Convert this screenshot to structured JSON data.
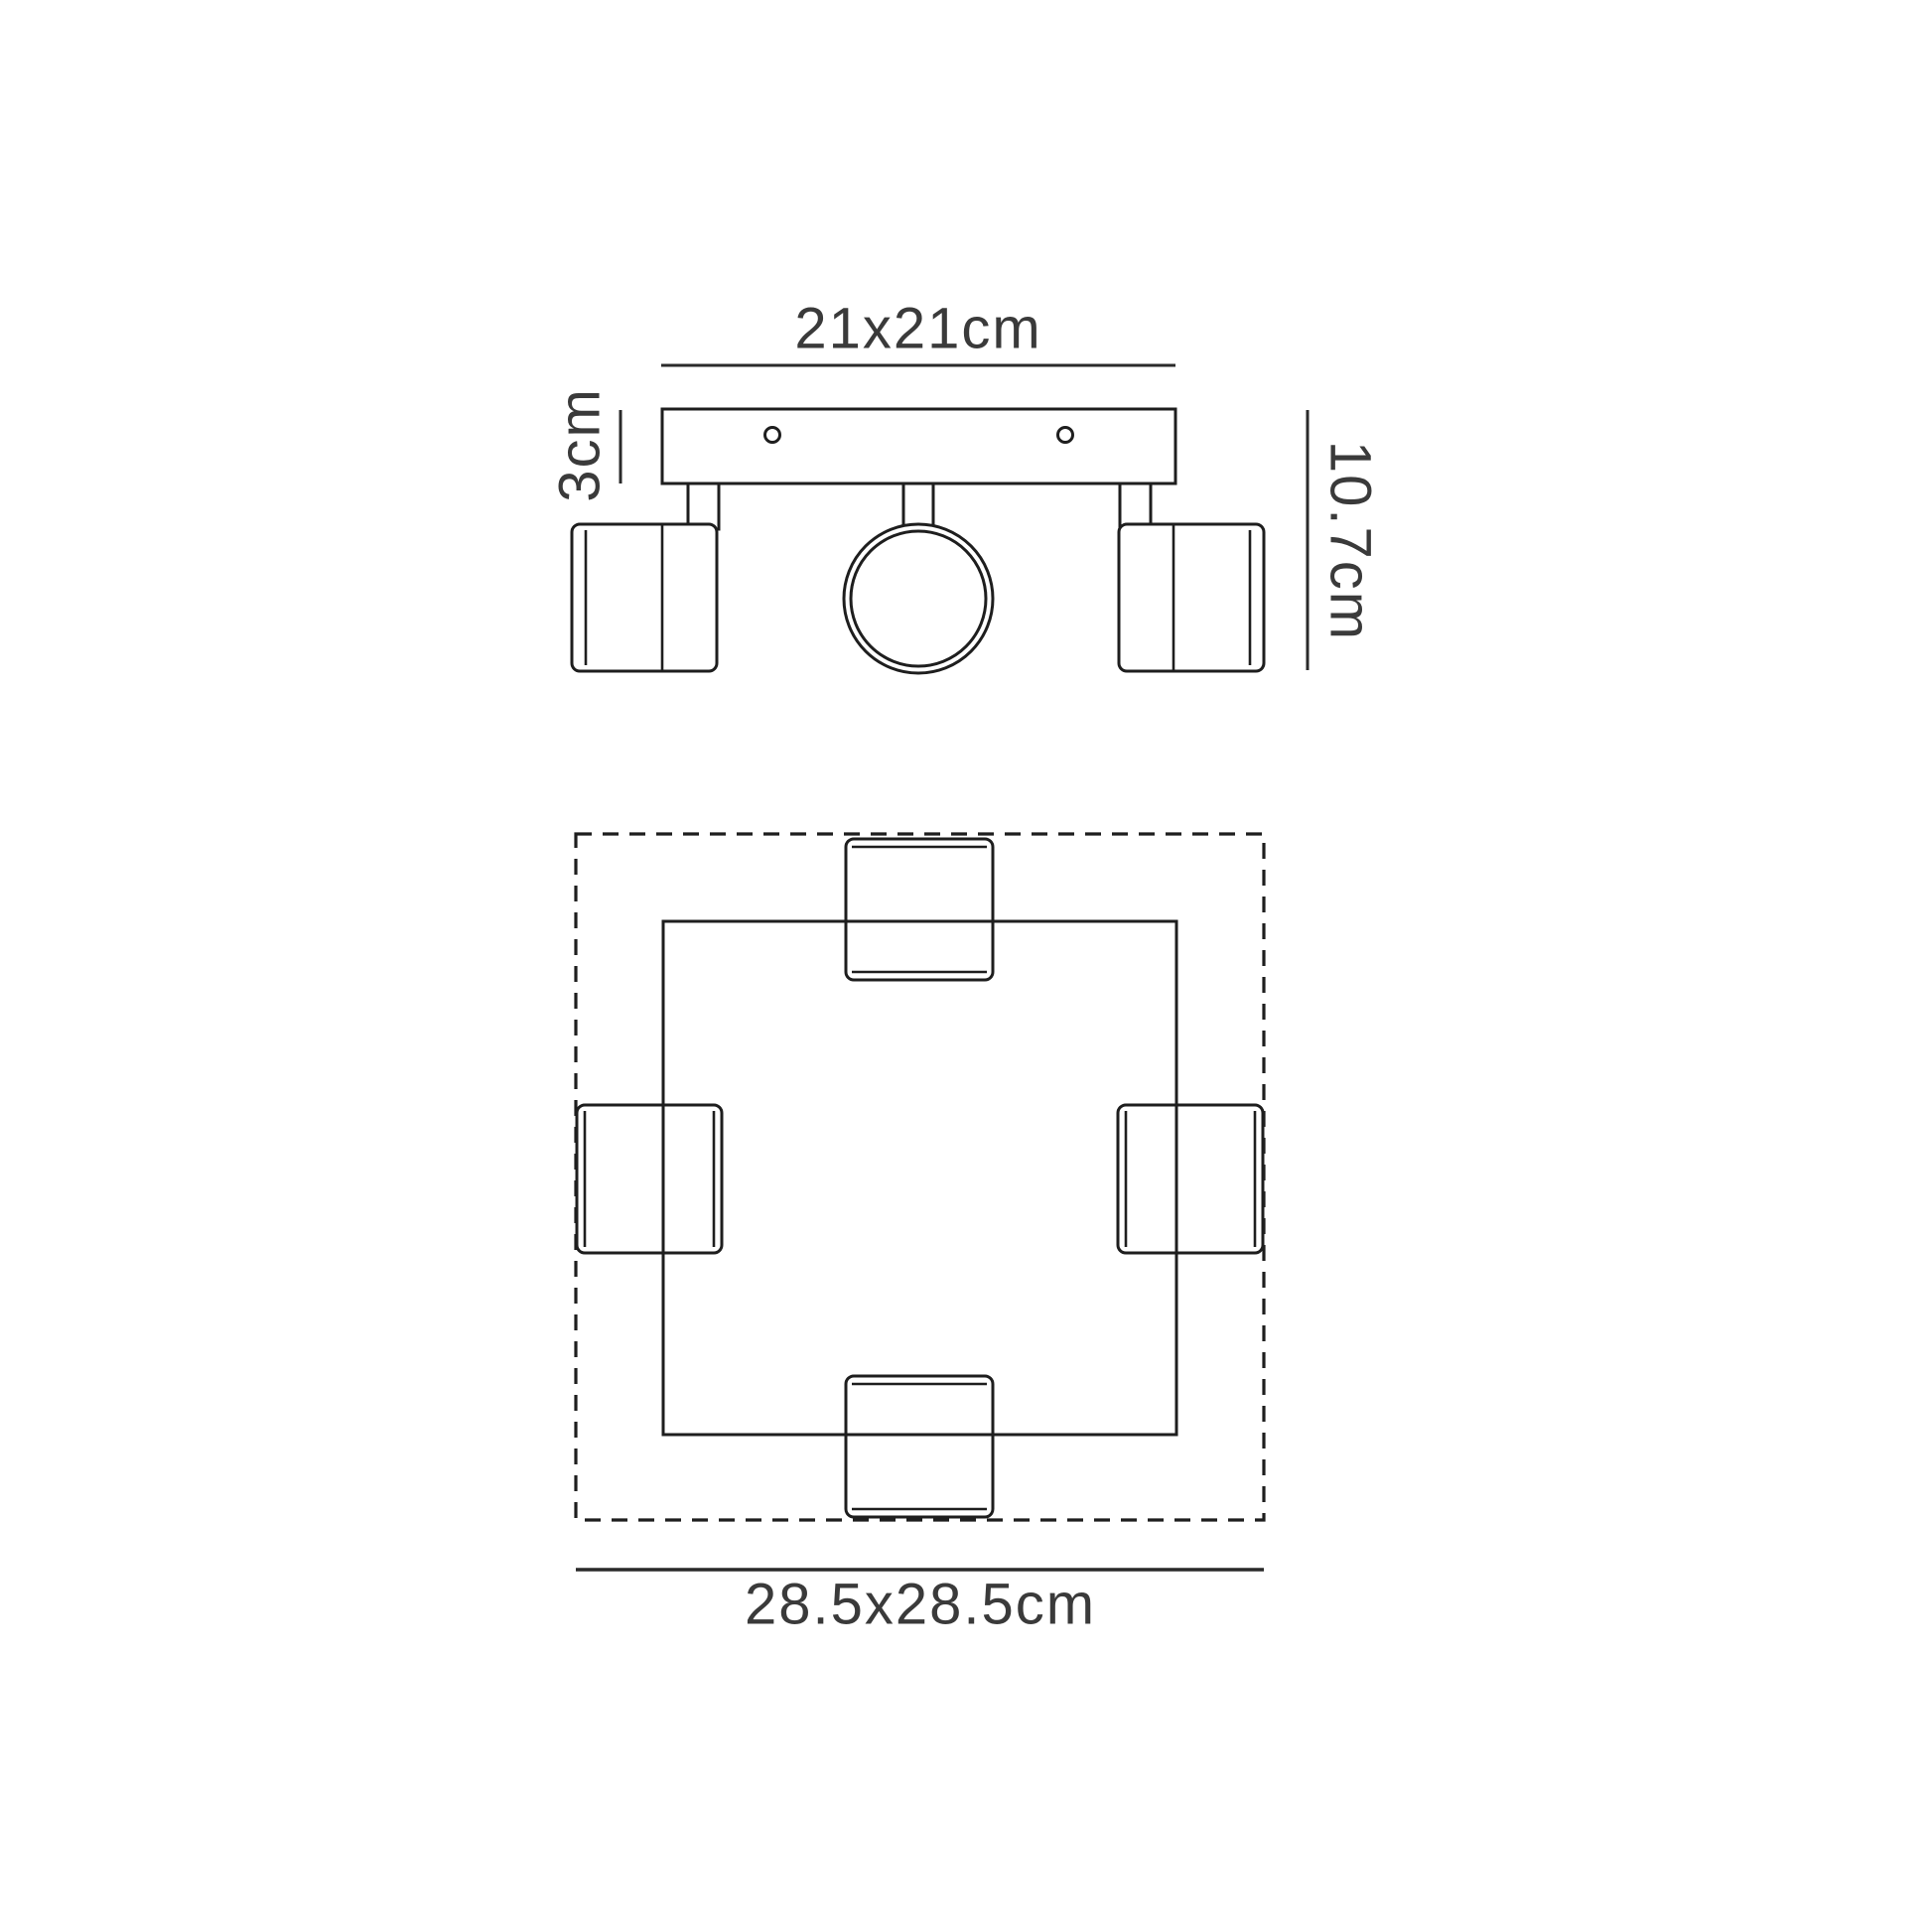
{
  "diagram": {
    "colors": {
      "ink": "#1e1e1e",
      "label_text": "#3a3a3a",
      "background": "#ffffff"
    },
    "side_view": {
      "plate_width_label": "21x21cm",
      "plate_thickness_label": "3cm",
      "fixture_height_label": "10.7cm"
    },
    "plan_view": {
      "footprint_label": "28.5x28.5cm"
    }
  }
}
